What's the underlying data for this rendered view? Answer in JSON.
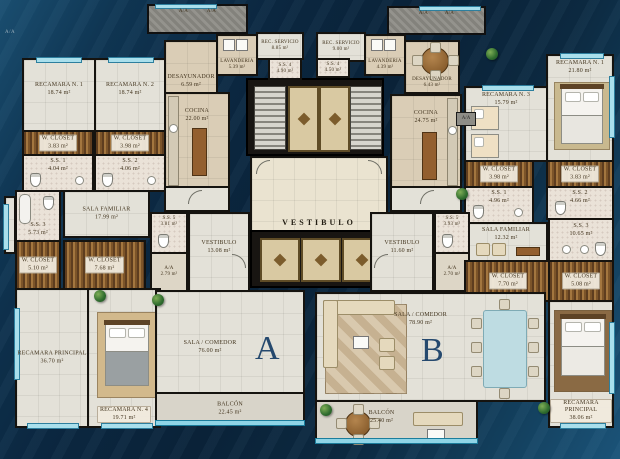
{
  "plan": {
    "core": {
      "vestibulo": "VESTIBULO"
    },
    "roof": {
      "a1": "A/A",
      "a2": "A/A",
      "a3": "A/A",
      "a4": "A/A"
    },
    "tags": {
      "left": "A/A",
      "right": "A/A"
    },
    "unit_a": {
      "letter": "A",
      "rec1": {
        "name": "RECAMARA N. 1",
        "area": "18.74 m²"
      },
      "rec2": {
        "name": "RECAMARA N. 2",
        "area": "18.74 m²"
      },
      "wcloset1": {
        "name": "W. CLOSET",
        "area": "3.83 m²"
      },
      "wcloset2": {
        "name": "W. CLOSET",
        "area": "3.98 m²"
      },
      "ss1": {
        "name": "S.S. 1",
        "area": "4.04 m²"
      },
      "ss2": {
        "name": "S.S. 2",
        "area": "4.06 m²"
      },
      "desayunador": {
        "name": "DESAYUNADOR",
        "area": "6.59 m²"
      },
      "lavanderia": {
        "name": "LAVANDERIA",
        "area": "5.39 m²"
      },
      "rec_servicio": {
        "name": "REC. SERVICIO",
        "area": "8.85 m²"
      },
      "ss4": {
        "name": "S.S. 4",
        "area": "4.90 m²"
      },
      "cocina": {
        "name": "COCINA",
        "area": "22.00 m²"
      },
      "sala_familiar": {
        "name": "SALA FAMILIAR",
        "area": "17.99 m²"
      },
      "ss3": {
        "name": "S.S. 3",
        "area": "5.73 m²"
      },
      "wcloset3": {
        "name": "W. CLOSET",
        "area": "5.10 m²"
      },
      "wcloset4": {
        "name": "W. CLOSET",
        "area": "7.68 m²"
      },
      "ss5": {
        "name": "S.S. 5",
        "area": "3.81 m²"
      },
      "vestibulo": {
        "name": "VESTIBULO",
        "area": "13.08 m²"
      },
      "aa": {
        "name": "A/A",
        "area": "2.79 m²"
      },
      "rec_principal": {
        "name": "RECAMARA PRINCIPAL",
        "area": "36.70 m²"
      },
      "rec4": {
        "name": "RECAMARA N. 4",
        "area": "19.71 m²"
      },
      "sala_comedor": {
        "name": "SALA / COMEDOR",
        "area": "76.00 m²"
      },
      "balcon": {
        "name": "BALCÓN",
        "area": "22.45 m²"
      }
    },
    "unit_b": {
      "letter": "B",
      "rec_servicio": {
        "name": "REC. SERVICIO",
        "area": "9.00 m²"
      },
      "ss4": {
        "name": "S.S. 4",
        "area": "4.50 m²"
      },
      "lavanderia": {
        "name": "LAVANDERIA",
        "area": "4.39 m²"
      },
      "desayunador": {
        "name": "DESAYUNADOR",
        "area": "6.43 m²"
      },
      "cocina": {
        "name": "COCINA",
        "area": "24.75 m²"
      },
      "rec3": {
        "name": "RECAMARA N. 3",
        "area": "15.79 m²"
      },
      "rec1": {
        "name": "RECAMARA N. 1",
        "area": "21.80 m²"
      },
      "wcloset1": {
        "name": "W. CLOSET",
        "area": "3.98 m²"
      },
      "wcloset2": {
        "name": "W. CLOSET",
        "area": "3.83 m²"
      },
      "ss1": {
        "name": "S.S. 1",
        "area": "4.96 m²"
      },
      "ss2": {
        "name": "S.S. 2",
        "area": "4.66 m²"
      },
      "sala_familiar": {
        "name": "SALA FAMILIAR",
        "area": "12.32 m²"
      },
      "ss5": {
        "name": "S.S. 5",
        "area": "3.93 m²"
      },
      "vestibulo": {
        "name": "VESTIBULO",
        "area": "11.60 m²"
      },
      "aa": {
        "name": "A/A",
        "area": "2.70 m²"
      },
      "wcloset3": {
        "name": "W. CLOSET",
        "area": "7.70 m²"
      },
      "wcloset4": {
        "name": "W. CLOSET",
        "area": "5.08 m²"
      },
      "ss3": {
        "name": "S.S. 3",
        "area": "10.65 m²"
      },
      "rec_principal": {
        "name": "RECAMARA PRINCIPAL",
        "area": "38.06 m²"
      },
      "sala_comedor": {
        "name": "SALA / COMEDOR",
        "area": "78.90 m²"
      },
      "balcon": {
        "name": "BALCÓN",
        "area": "25.40 m²"
      }
    }
  }
}
